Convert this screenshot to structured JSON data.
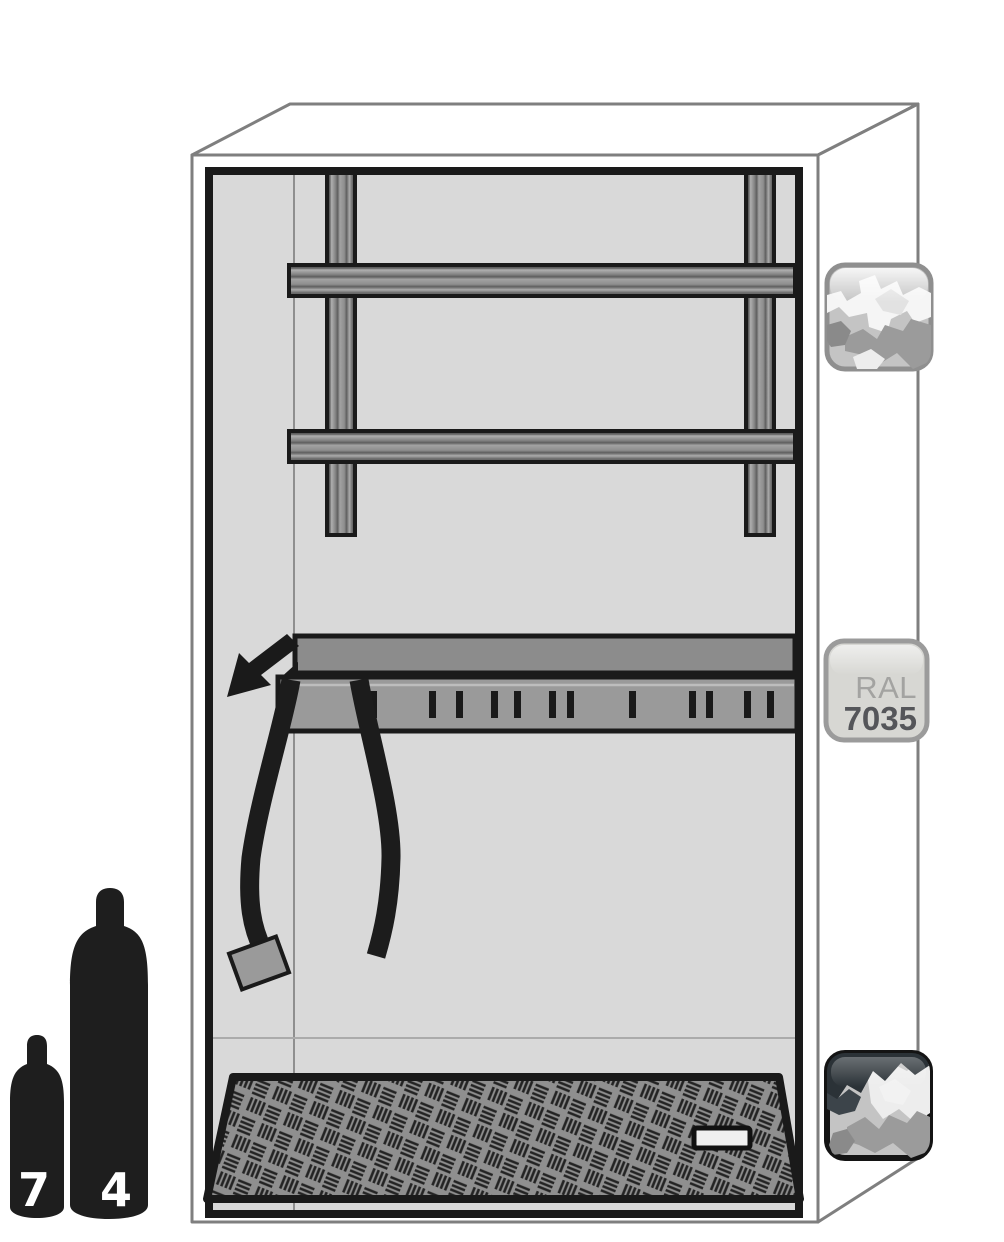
{
  "illustration": {
    "subject": "gas-cylinder-cabinet-interior",
    "ral_swatch": {
      "label": "RAL",
      "code": "7035",
      "color_hex": "#d7d7d3"
    },
    "cylinder_badges": {
      "small": "7",
      "large": "4"
    },
    "colors": {
      "outline_gray": "#7f7f7f",
      "interior_gray": "#d9d9d9",
      "rail_gray": "#8f8f8f",
      "ink_black": "#1a1a1a"
    }
  }
}
